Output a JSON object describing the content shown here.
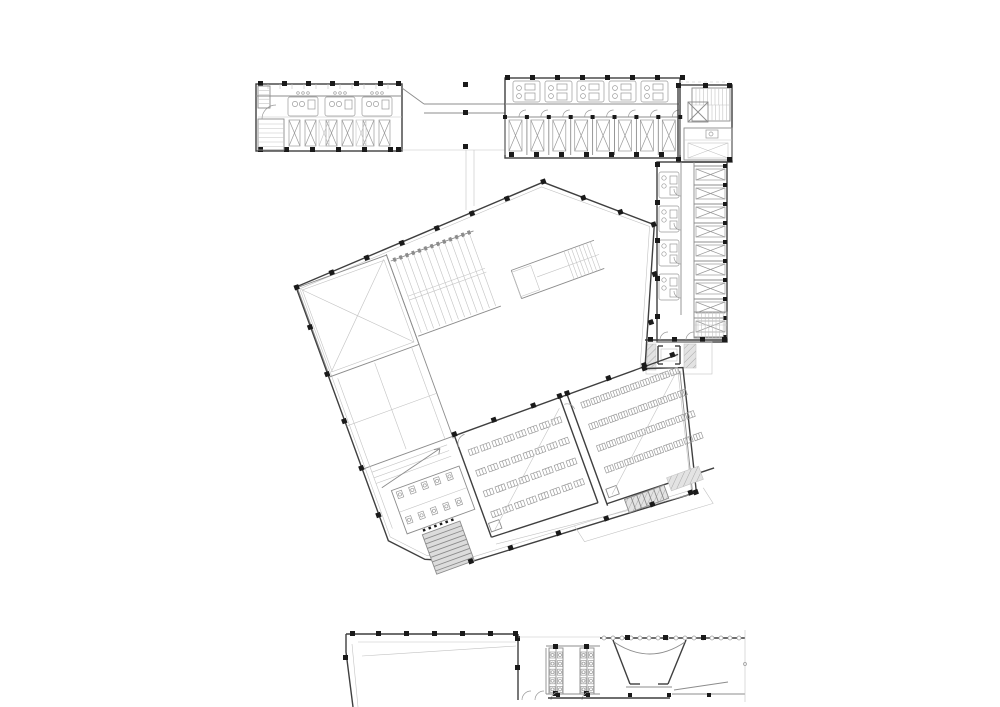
{
  "drawing": {
    "label": "Architectural floor plan drawing",
    "type": "floor-plan"
  },
  "palette": {
    "background": "#ffffff",
    "wall": "#3f3f3f",
    "medium": "#8c8c8c",
    "light": "#c3c3c3",
    "furniture": "#9a9a9a",
    "column": "#1a1a1a",
    "hatch_fill": "#e3e3e3",
    "hatch_line": "#a8a8a8",
    "stair_fill": "#dcdcdc"
  },
  "northwest_wing": {
    "bathroom_pods": 3,
    "bed_pairs": 3,
    "extra_beds": 2,
    "staircases": 2
  },
  "bridge": {
    "walkway_lines": 2,
    "columns": 3
  },
  "northeast_wing": {
    "bathroom_pods": 5,
    "rooms": 8,
    "beds": 8
  },
  "stair_core": {
    "stair_treads": 9,
    "lower_treads": 5,
    "elevators": 1
  },
  "east_wing": {
    "rooms": 9,
    "beds": 9,
    "bathroom_pods": 4,
    "stair_treads": 8
  },
  "east_connector": {
    "skylight_shafts": 1,
    "hatched_stairs": 2
  },
  "central_block": {
    "rotation_deg": -20,
    "grand_stair_treads": 13,
    "hall_stair_treads": 8,
    "classroom_small": {
      "desk_rows": 4,
      "desk_cols": 8
    },
    "classroom_large": {
      "desk_rows": 4,
      "desk_cols": 10
    },
    "toilet_stall_rows": 2,
    "toilet_stalls_per_row": 5,
    "tip_stair_treads": 8,
    "ramp_treads": 3,
    "exterior_ramp_treads": 6
  },
  "south_building": {
    "toilet_banks": 2,
    "fixtures_per_side": 5,
    "fan_rooms": 1,
    "arc_column_squares": 3,
    "foyer_top_columns": 7
  }
}
